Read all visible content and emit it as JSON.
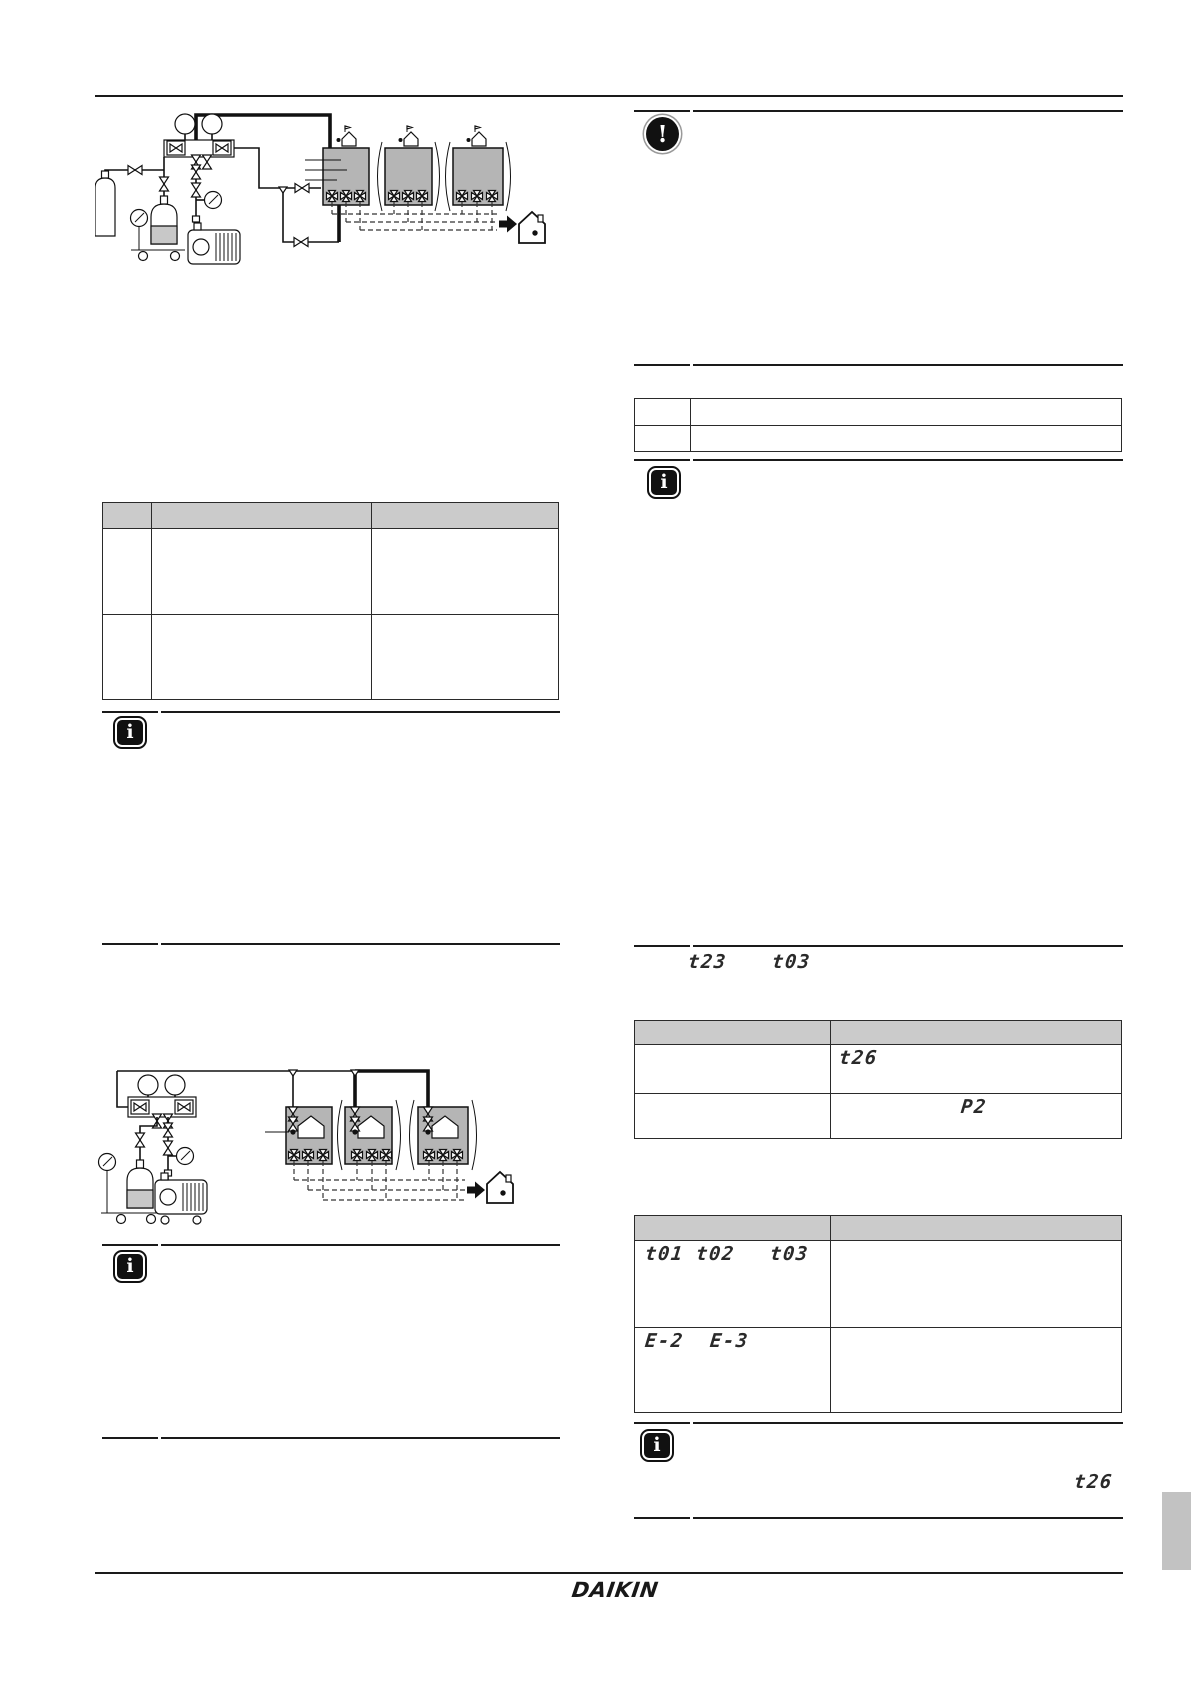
{
  "brand": {
    "logo_text": "DAIKIN"
  },
  "icons": {
    "notice_glyph": "!",
    "info_glyph": "i"
  },
  "right_column": {
    "display_codes_line": {
      "code_1": "t23",
      "code_2": "t03"
    },
    "checking_table": {
      "rows": [
        {
          "code": "t26"
        },
        {
          "code": "P2"
        }
      ]
    },
    "error_codes_table": {
      "rows": [
        {
          "codes": [
            "t01",
            "t02",
            "t03"
          ]
        },
        {
          "codes": [
            "E-2",
            "E-3"
          ]
        }
      ]
    },
    "info_note_code": "t26"
  },
  "colors": {
    "table_header_bg": "#cbcbcb",
    "unit_fill": "#b5b5b5",
    "page_tab": "#c2c2c2",
    "line": "#1a1a1a"
  }
}
